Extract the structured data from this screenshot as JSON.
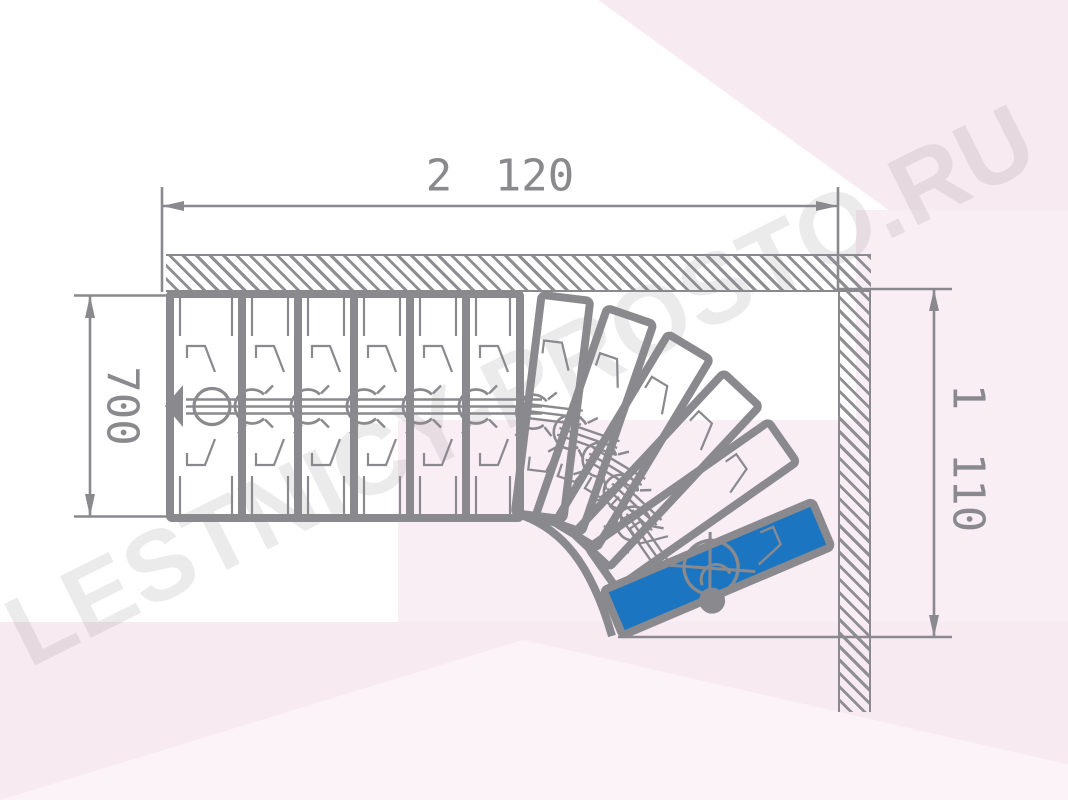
{
  "title": "Winder staircase floor plan (90-degree turn)",
  "watermark": {
    "text": "LESTNICY-PROSTO.RU"
  },
  "dimensions": {
    "top_width": "2 120",
    "left_height": "700",
    "right_height": "1 110"
  },
  "stair": {
    "straight_treads": 6,
    "winder_treads": 6,
    "highlighted_tread_index": 12,
    "turn_direction": "clockwise"
  },
  "icons": [
    "walk-direction-arrow-icon",
    "center-post-icon",
    "pivot-dot-icon",
    "wall-hatch-pattern"
  ],
  "colors": {
    "line": "#8a8a8e",
    "highlight_tread": "#1c75c1",
    "background_tint_1": "#f7ebf1",
    "background_tint_2": "#f9eef4",
    "background_tint_3": "#fbf3f7",
    "watermark": "rgba(100,88,100,0.12)"
  }
}
